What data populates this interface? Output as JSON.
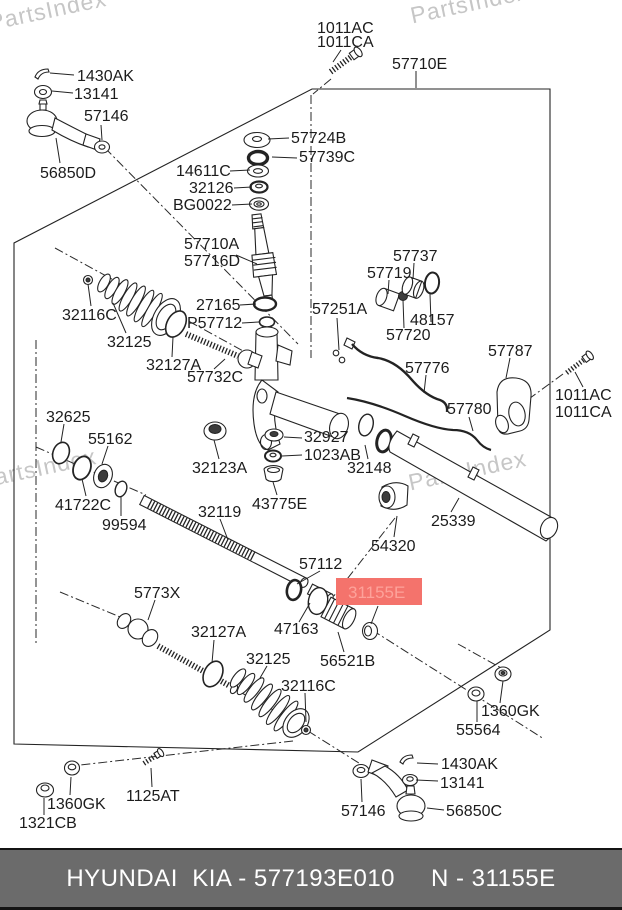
{
  "watermark": "PartsIndex",
  "colors": {
    "highlight_bg": "#f4736c",
    "highlight_text": "#fda29a",
    "footer_bg": "#6b6b6b",
    "line": "#232323",
    "watermark_gray": "#c6c6c6"
  },
  "highlight": {
    "label": "31155E"
  },
  "footer": {
    "left": "HYUNDAI  KIA - 577193E010",
    "right": "N - 31155E"
  },
  "labels": {
    "bolt_top_1": "1011AC",
    "bolt_top_2": "1011CA",
    "gear_assy": "57710E",
    "cotter_tl": "1430AK",
    "nut_tl": "13141",
    "nut_57146_t": "57146",
    "tie_rod_end_tl": "56850D",
    "washer_57724b": "57724B",
    "ring_57739c": "57739C",
    "washer_14611c": "14611C",
    "seal_32126": "32126",
    "bearing_bg0022": "BG0022",
    "pinion_1": "57710A",
    "pinion_2": "57716D",
    "ring_27165": "27165",
    "seal_p57712": "P57712",
    "clip_57251a": "57251A",
    "sleeve_57737": "57737",
    "bush_57719": "57719",
    "oring_48157": "48157",
    "ring_57720": "57720",
    "clamp_57787": "57787",
    "tube_57776": "57776",
    "tube_57780": "57780",
    "bolt_right_1": "1011AC",
    "bolt_right_2": "1011CA",
    "clamp_32116c_u": "32116C",
    "boot_32125_u": "32125",
    "ring_32127a_u": "32127A",
    "rod_57732c": "57732C",
    "oring_32625": "32625",
    "washer_55162": "55162",
    "washer_41722c": "41722C",
    "ring_99594": "99594",
    "bush_32123a": "32123A",
    "nut_32927": "32927",
    "nut_1023ab": "1023AB",
    "seal_32148": "32148",
    "cap_43775e": "43775E",
    "rack_32119": "32119",
    "tube_25339": "25339",
    "bush_54320": "54320",
    "rod_5773x": "5773X",
    "ring_57112": "57112",
    "ring_47163": "47163",
    "ring_32127a_l": "32127A",
    "bush_56521b": "56521B",
    "boot_32125_l": "32125",
    "clamp_32116c_l": "32116C",
    "nut_1360gk_r": "1360GK",
    "nut_55564": "55564",
    "cotter_br": "1430AK",
    "nut_br": "13141",
    "nut_57146_b": "57146",
    "tie_rod_end_br": "56850C",
    "nut_1360gk_l": "1360GK",
    "nut_1321cb": "1321CB",
    "bolt_1125at": "1125AT"
  }
}
